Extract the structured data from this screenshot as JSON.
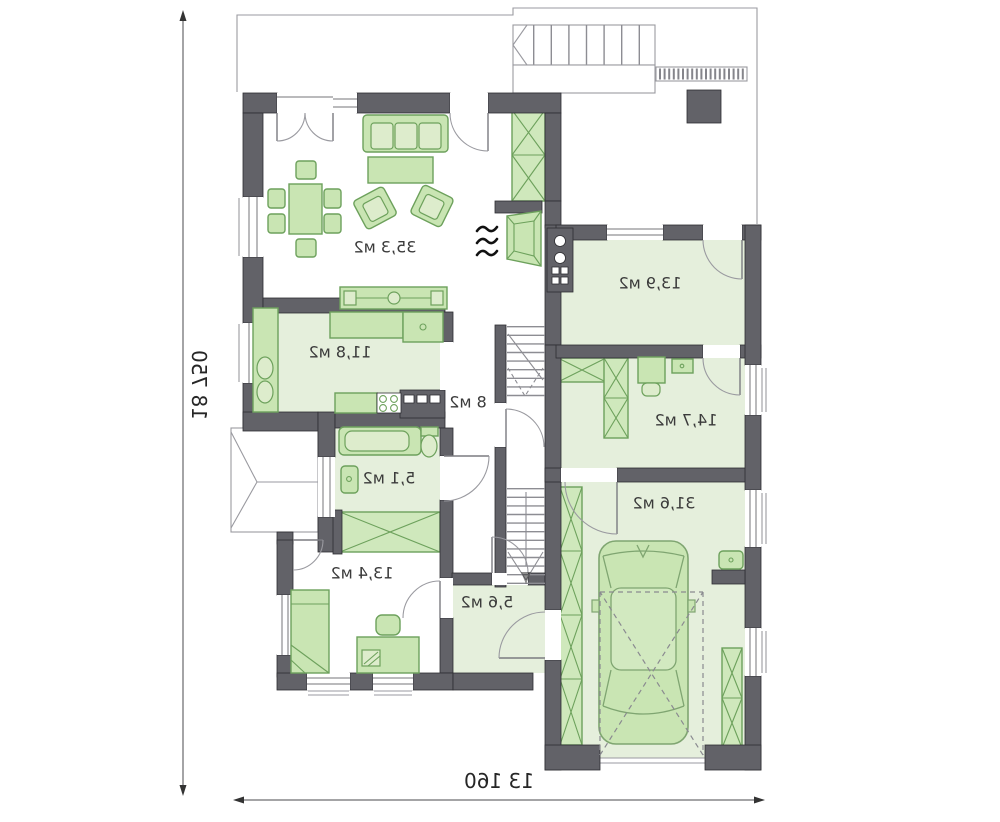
{
  "plan": {
    "title": "first-floor-plan",
    "rooms": [
      {
        "name": "living-room",
        "area": "35,3 м2"
      },
      {
        "name": "kitchen",
        "area": "11,8 м2"
      },
      {
        "name": "hall",
        "area": "8 м2"
      },
      {
        "name": "bathroom",
        "area": "5,1 м2"
      },
      {
        "name": "bedroom",
        "area": "13,4 м2"
      },
      {
        "name": "hallway",
        "area": "5,6 м2"
      },
      {
        "name": "room-13-9",
        "area": "13,9 м2"
      },
      {
        "name": "room-14-7",
        "area": "14,7 м2"
      },
      {
        "name": "garage",
        "area": "31,6 м2"
      }
    ],
    "dimensions": {
      "height": "18 750",
      "width": "13 160"
    },
    "colors": {
      "wall": "#626268",
      "floor_green": "#e5efdc",
      "furniture_green": "#c9e5b3",
      "furniture_border": "#6da15c",
      "outline_gray": "#9a9aa0"
    }
  }
}
